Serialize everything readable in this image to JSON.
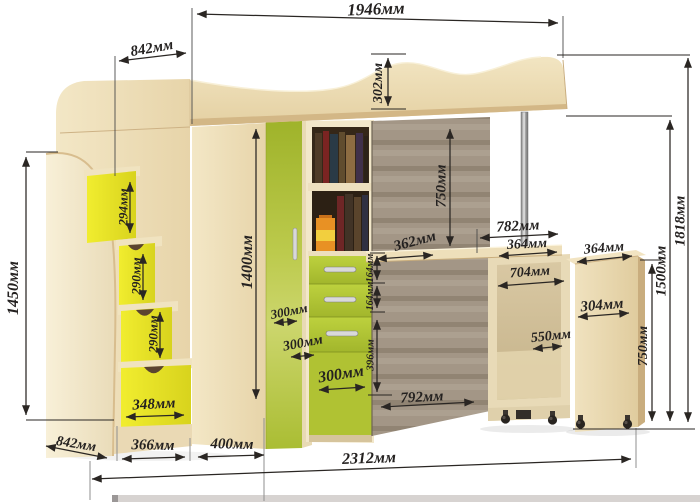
{
  "drawing": {
    "type": "furniture-dimension-diagram",
    "subject": "loft bed with corner wardrobe, stairs-chest and pull-out desk",
    "unit": "мм"
  },
  "colors": {
    "line": "#2a2623",
    "wood_light": "#f1e4c0",
    "wood_mid": "#e6d2a5",
    "wood_edge": "#c9ad7e",
    "lime_green": "#a9bc31",
    "lime_light": "#cbd56b",
    "step_yellow": "#ecе82b",
    "back_panel_taupe": "#9d9080",
    "pillow_orange": "#e07a1e",
    "chrome": "#c9c9c9",
    "background": "#ffffff"
  },
  "dimensions": {
    "top_width": "1946мм",
    "upper_depth": "842мм",
    "headboard_height": "302мм",
    "stair_unit_height": "1450мм",
    "step_1_height": "294мм",
    "step_2_height": "290мм",
    "step_3_height": "290мм",
    "stair_drawer_width": "348мм",
    "wardrobe_height": "1400мм",
    "corner_face_a": "300мм",
    "corner_face_b": "300мм",
    "corner_face_c": "300мм",
    "desk_inset_width": "362мм",
    "shelf_drawer_height_1": "164мм",
    "shelf_drawer_height_2": "164мм",
    "lower_door_height": "396мм",
    "underbed_clearance": "750мм",
    "desktop_width": "782мм",
    "desktop_segment": "364мм",
    "cabinet_top_depth": "364мм",
    "desk_opening_width": "704мм",
    "pedestal_depth": "550мм",
    "cabinet_width": "304мм",
    "cabinet_height": "750мм",
    "desk_total_height": "1500мм",
    "overall_height": "1818мм",
    "desk_length": "792мм",
    "base_depth": "842мм",
    "base_segment_1": "366мм",
    "base_segment_2": "400мм",
    "overall_length": "2312мм"
  }
}
